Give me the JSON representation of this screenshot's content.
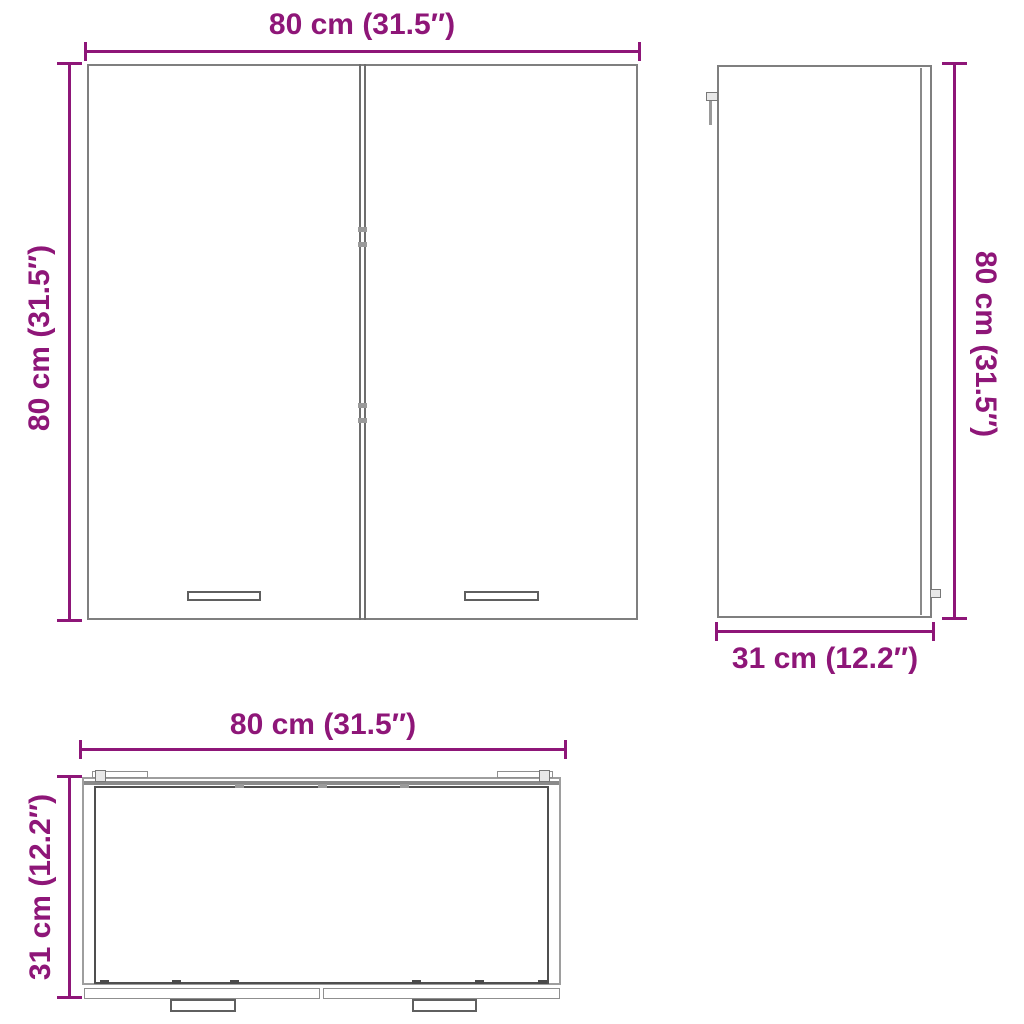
{
  "title": "Wall cabinet dimension diagram",
  "colors": {
    "accent": "#8e1678",
    "cabinet_line": "#7f7f7f"
  },
  "views": {
    "front": {
      "name": "front view",
      "top_width_label": "80 cm (31.5″)",
      "left_height_label": "80 cm (31.5″)"
    },
    "side": {
      "name": "side view",
      "right_height_label": "80 cm (31.5″)",
      "bottom_depth_label": "31 cm (12.2″)"
    },
    "bottom": {
      "name": "bottom view",
      "top_width_label": "80 cm (31.5″)",
      "left_depth_label": "31 cm (12.2″)"
    }
  }
}
